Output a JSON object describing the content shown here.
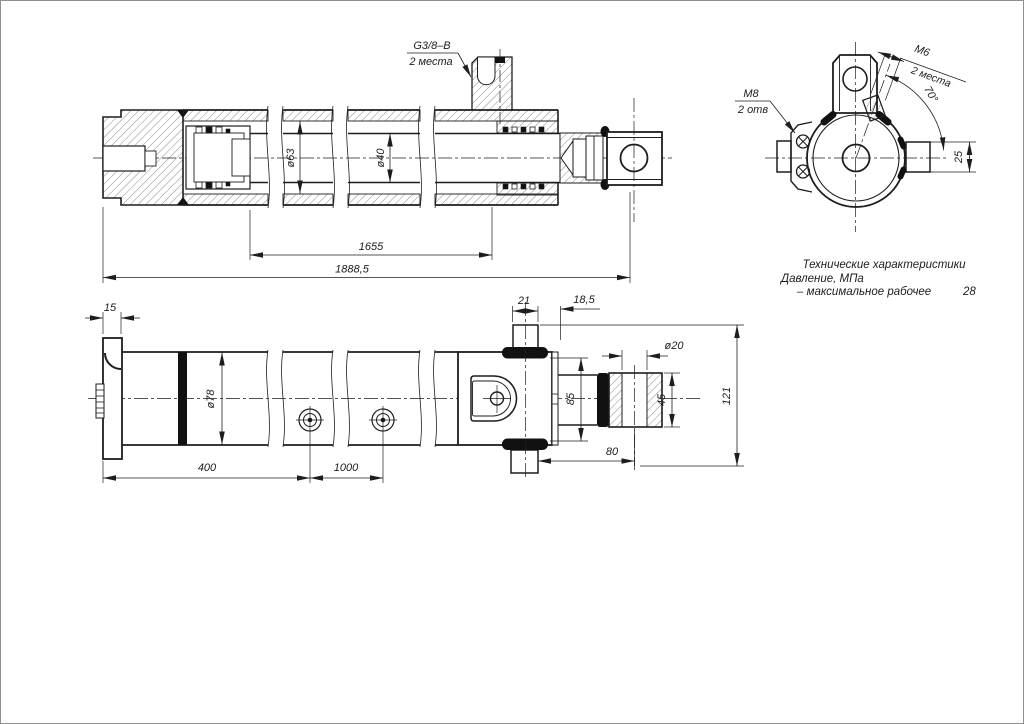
{
  "section_view": {
    "port_label": "G3/8–B",
    "port_note": "2 места",
    "dim_bore": "ø63",
    "dim_rod": "ø40",
    "dim_stroke": "1655",
    "dim_total": "1888,5"
  },
  "end_view": {
    "thread_top": "M6",
    "thread_top_note": "2 места",
    "angle": "70°",
    "thread_side": "M8",
    "thread_side_note": "2 отв",
    "dim_boss": "25"
  },
  "plan_view": {
    "dim_flange": "15",
    "dim_od": "ø78",
    "dim_l1": "400",
    "dim_l2": "1000",
    "dim_port_w": "21",
    "dim_port_off": "18,5",
    "dim_pin_hole": "ø20",
    "dim_across_ports": "85",
    "dim_clevis": "45",
    "dim_height": "121",
    "dim_rod_ext": "80"
  },
  "specs": {
    "title": "Технические характеристики",
    "param": "Давление, МПа",
    "param_detail": "– максимальное рабочее",
    "value": "28"
  }
}
